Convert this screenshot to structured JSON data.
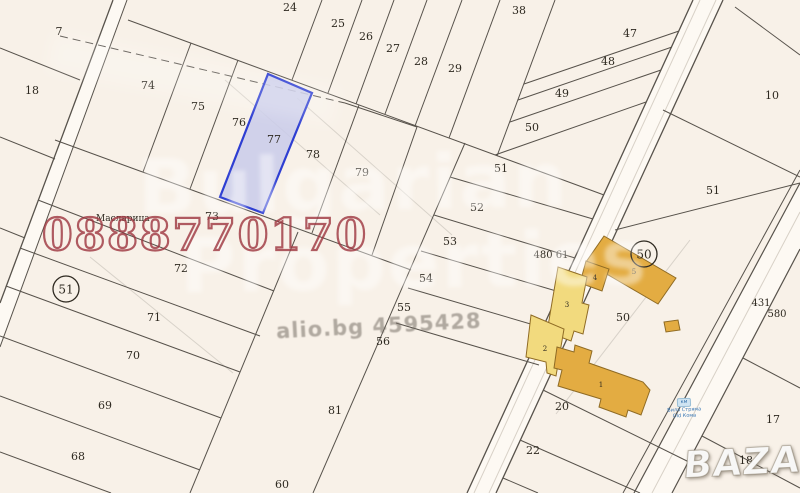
{
  "map": {
    "background": "#f8f1e8",
    "line_color": "#57524b",
    "road_fill": "#fdf9f3",
    "highlighted_parcel": {
      "label": "77",
      "fill": "#c9cbea",
      "border": "#2e3ed2"
    },
    "building_colors": {
      "light": "#f2da7e",
      "dark": "#e3ac42",
      "border": "#8f6b24"
    },
    "place_label": {
      "text": "Масларица",
      "x": 96,
      "y": 217
    },
    "parcels": [
      {
        "n": "7",
        "x": 59,
        "y": 31
      },
      {
        "n": "9",
        "x": -3,
        "y": 172
      },
      {
        "n": "18",
        "x": 32,
        "y": 90
      },
      {
        "n": "74",
        "x": 148,
        "y": 85
      },
      {
        "n": "75",
        "x": 198,
        "y": 106
      },
      {
        "n": "76",
        "x": 239,
        "y": 122
      },
      {
        "n": "77",
        "x": 274,
        "y": 139
      },
      {
        "n": "78",
        "x": 313,
        "y": 154
      },
      {
        "n": "79",
        "x": 362,
        "y": 172
      },
      {
        "n": "73",
        "x": 212,
        "y": 216
      },
      {
        "n": "72",
        "x": 181,
        "y": 268
      },
      {
        "n": "71",
        "x": 154,
        "y": 317
      },
      {
        "n": "70",
        "x": 133,
        "y": 355
      },
      {
        "n": "69",
        "x": 105,
        "y": 405
      },
      {
        "n": "68",
        "x": 78,
        "y": 456
      },
      {
        "n": "24",
        "x": 290,
        "y": 7
      },
      {
        "n": "25",
        "x": 338,
        "y": 23
      },
      {
        "n": "26",
        "x": 366,
        "y": 36
      },
      {
        "n": "27",
        "x": 393,
        "y": 48
      },
      {
        "n": "28",
        "x": 421,
        "y": 61
      },
      {
        "n": "29",
        "x": 455,
        "y": 68
      },
      {
        "n": "38",
        "x": 519,
        "y": 10
      },
      {
        "n": "47",
        "x": 630,
        "y": 33
      },
      {
        "n": "48",
        "x": 608,
        "y": 61
      },
      {
        "n": "49",
        "x": 562,
        "y": 93
      },
      {
        "n": "50",
        "x": 532,
        "y": 127
      },
      {
        "n": "51",
        "x": 501,
        "y": 168
      },
      {
        "n": "52",
        "x": 477,
        "y": 207
      },
      {
        "n": "53",
        "x": 450,
        "y": 241
      },
      {
        "n": "54",
        "x": 426,
        "y": 278
      },
      {
        "n": "55",
        "x": 404,
        "y": 307
      },
      {
        "n": "56",
        "x": 383,
        "y": 341
      },
      {
        "n": "81",
        "x": 335,
        "y": 410
      },
      {
        "n": "60",
        "x": 282,
        "y": 484
      },
      {
        "n": "10",
        "x": 772,
        "y": 95
      },
      {
        "n": "51",
        "x": 713,
        "y": 190
      },
      {
        "n": "431",
        "x": 761,
        "y": 302,
        "size": 10
      },
      {
        "n": "580",
        "x": 777,
        "y": 313,
        "size": 10
      },
      {
        "n": "480 61",
        "x": 551,
        "y": 254,
        "size": 10
      },
      {
        "n": "50",
        "x": 623,
        "y": 317
      },
      {
        "n": "20",
        "x": 562,
        "y": 406
      },
      {
        "n": "22",
        "x": 533,
        "y": 450
      },
      {
        "n": "17",
        "x": 773,
        "y": 419
      },
      {
        "n": "18",
        "x": 746,
        "y": 460
      }
    ],
    "circled_labels": [
      {
        "n": "51",
        "x": 66,
        "y": 289
      },
      {
        "n": "50",
        "x": 644,
        "y": 254
      }
    ],
    "building_labels": [
      {
        "n": "1",
        "x": 601,
        "y": 383
      },
      {
        "n": "2",
        "x": 545,
        "y": 347
      },
      {
        "n": "3",
        "x": 567,
        "y": 303
      },
      {
        "n": "4",
        "x": 595,
        "y": 276
      },
      {
        "n": "5",
        "x": 634,
        "y": 270
      }
    ]
  },
  "watermarks": {
    "phone": "0888770170",
    "brand_line1": "Bulgarian",
    "brand_line2": "Properties",
    "listing_id": "alio.bg 4595428",
    "logo": "BAZAR"
  },
  "road_sign": {
    "badge": "км",
    "line1": "Вила Стряма",
    "line2": "Old Кома"
  }
}
